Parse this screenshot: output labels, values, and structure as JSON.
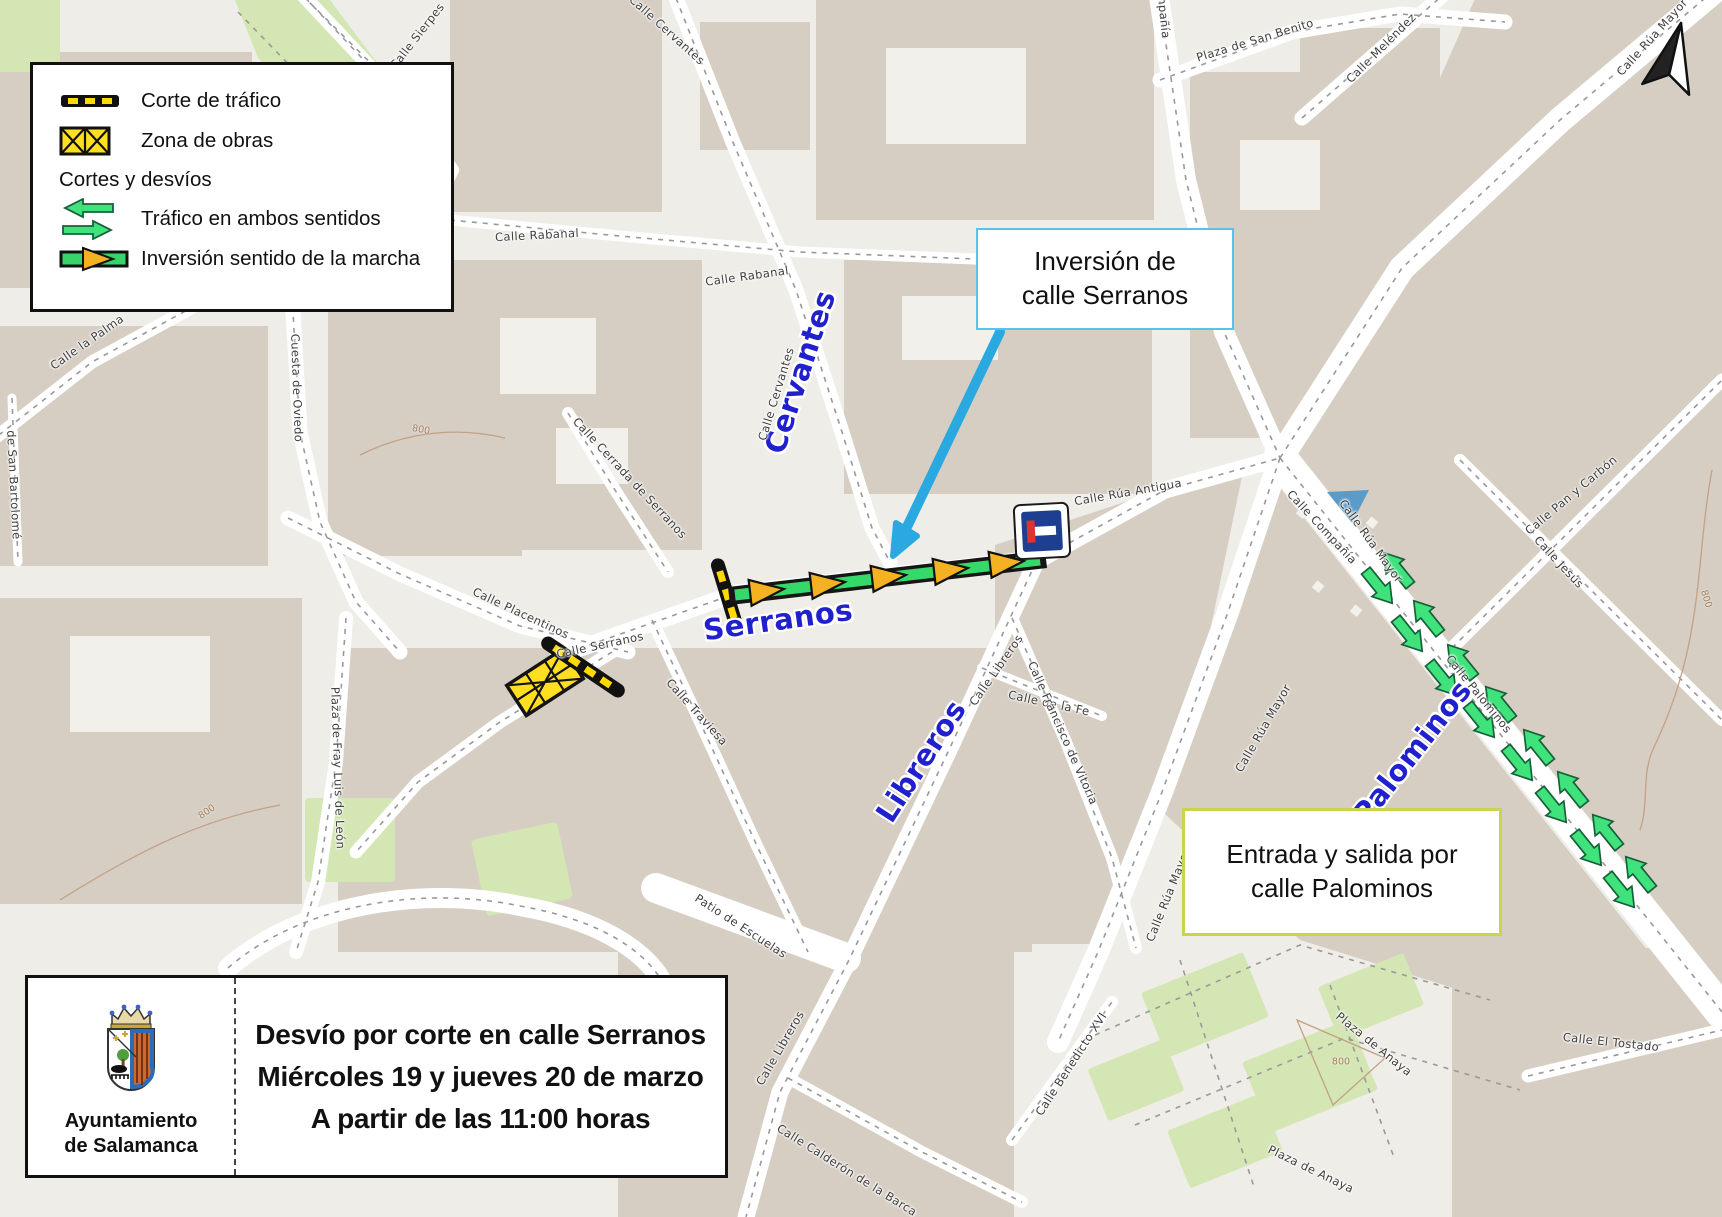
{
  "legend": {
    "items": [
      {
        "label": "Corte de tráfico",
        "icon": "traffic-cut"
      },
      {
        "label": "Zona de obras",
        "icon": "work-zone"
      },
      {
        "label": "Cortes y desvíos",
        "icon": "none"
      },
      {
        "label": "Tráfico en ambos sentidos",
        "icon": "two-way-arrows"
      },
      {
        "label": "Inversión sentido de la marcha",
        "icon": "direction-reversal"
      }
    ]
  },
  "callouts": {
    "inversion": {
      "line1": "Inversión de",
      "line2": "calle Serranos"
    },
    "entrada": {
      "line1": "Entrada y salida por",
      "line2": "calle Palominos"
    }
  },
  "info": {
    "org_line1": "Ayuntamiento",
    "org_line2": "de Salamanca",
    "title_line1": "Desvío por corte en calle Serranos",
    "title_line2": "Miércoles 19 y jueves 20 de marzo",
    "title_line3": "A partir de las 11:00 horas"
  },
  "colors": {
    "pointer_arrow_blue": "#2aa9e0",
    "inversion_border": "#56c2ef",
    "entrada_border": "#c9d64c",
    "diversion_green": "#3fe27b",
    "bar_green": "#35d96a",
    "arrow_yellow": "#f4b223",
    "cut_yellow": "#ffd900",
    "work_zone_yellow": "#ffdf1f",
    "street_label_blue": "#2020cf",
    "building_grey": "#d6cec3",
    "park_green": "#d4e6b4"
  },
  "map": {
    "labels": [
      {
        "t": "Cervantes",
        "x": 800,
        "y": 372,
        "r": -72,
        "c": "major"
      },
      {
        "t": "Serranos",
        "x": 778,
        "y": 620,
        "r": -8,
        "c": "major"
      },
      {
        "t": "Libreros",
        "x": 921,
        "y": 761,
        "r": -57,
        "c": "major"
      },
      {
        "t": "Palominos",
        "x": 1412,
        "y": 752,
        "r": -52,
        "c": "major"
      },
      {
        "t": "Calle Sierpes",
        "x": 417,
        "y": 36,
        "r": -52,
        "c": "minor"
      },
      {
        "t": "Calle Cervantes",
        "x": 667,
        "y": 30,
        "r": 42,
        "c": "minor"
      },
      {
        "t": "Calle Rabanal",
        "x": 537,
        "y": 235,
        "r": -3,
        "c": "minor"
      },
      {
        "t": "Calle Rabanal",
        "x": 747,
        "y": 276,
        "r": -8,
        "c": "minor"
      },
      {
        "t": "Calle Cervantes",
        "x": 776,
        "y": 394,
        "r": -73,
        "c": "minor"
      },
      {
        "t": "Calle Cerrada de Serranos",
        "x": 630,
        "y": 478,
        "r": 47,
        "c": "minor"
      },
      {
        "t": "Cuesta de Oviedo",
        "x": 297,
        "y": 388,
        "r": 88,
        "c": "minor"
      },
      {
        "t": "Calle la Palma",
        "x": 87,
        "y": 342,
        "r": -35,
        "c": "minor"
      },
      {
        "t": "de San Bartolomé",
        "x": 14,
        "y": 485,
        "r": 87,
        "c": "minor"
      },
      {
        "t": "Plaza de Fray Luis de León",
        "x": 338,
        "y": 768,
        "r": 88,
        "c": "minor"
      },
      {
        "t": "Calle Placentinos",
        "x": 521,
        "y": 613,
        "r": 25,
        "c": "minor"
      },
      {
        "t": "Calle Serranos",
        "x": 600,
        "y": 645,
        "r": -12,
        "c": "minor"
      },
      {
        "t": "Calle Traviesa",
        "x": 697,
        "y": 712,
        "r": 48,
        "c": "minor"
      },
      {
        "t": "Patio de Escuelas",
        "x": 741,
        "y": 926,
        "r": 33,
        "c": "minor"
      },
      {
        "t": "Calle Libreros",
        "x": 996,
        "y": 670,
        "r": -55,
        "c": "minor"
      },
      {
        "t": "Calle Libreros",
        "x": 780,
        "y": 1048,
        "r": -60,
        "c": "minor"
      },
      {
        "t": "Calle de la Fe",
        "x": 1049,
        "y": 703,
        "r": 12,
        "c": "minor"
      },
      {
        "t": "Calle Francisco de Vitoria",
        "x": 1063,
        "y": 733,
        "r": 66,
        "c": "minor"
      },
      {
        "t": "Calle Rúa Antigua",
        "x": 1128,
        "y": 492,
        "r": -10,
        "c": "minor"
      },
      {
        "t": "Compañía",
        "x": 1163,
        "y": 8,
        "r": 84,
        "c": "minor"
      },
      {
        "t": "Calle Compañía",
        "x": 1322,
        "y": 527,
        "r": 47,
        "c": "minor"
      },
      {
        "t": "Calle Rúa Mayor",
        "x": 1371,
        "y": 541,
        "r": 54,
        "c": "minor"
      },
      {
        "t": "Calle Rúa Mayor",
        "x": 1263,
        "y": 728,
        "r": -60,
        "c": "minor"
      },
      {
        "t": "Calle Rúa Mayor",
        "x": 1168,
        "y": 895,
        "r": -68,
        "c": "minor"
      },
      {
        "t": "Plaza de San Benito",
        "x": 1255,
        "y": 40,
        "r": -17,
        "c": "minor"
      },
      {
        "t": "Calle Meléndez",
        "x": 1381,
        "y": 48,
        "r": -45,
        "c": "minor"
      },
      {
        "t": "Calle Rúa Mayor",
        "x": 1652,
        "y": 37,
        "r": -48,
        "c": "minor"
      },
      {
        "t": "Calle Pan y Carbón",
        "x": 1571,
        "y": 495,
        "r": -40,
        "c": "minor"
      },
      {
        "t": "Calle Jesús",
        "x": 1559,
        "y": 562,
        "r": 47,
        "c": "minor"
      },
      {
        "t": "Calle Palominos",
        "x": 1479,
        "y": 694,
        "r": 51,
        "c": "minor"
      },
      {
        "t": "Calle Benedicto XVI",
        "x": 1071,
        "y": 1064,
        "r": -57,
        "c": "minor"
      },
      {
        "t": "Plaza de Anaya",
        "x": 1374,
        "y": 1044,
        "r": 39,
        "c": "minor"
      },
      {
        "t": "Plaza de Anaya",
        "x": 1311,
        "y": 1169,
        "r": 26,
        "c": "minor"
      },
      {
        "t": "Calle El Tostado",
        "x": 1611,
        "y": 1042,
        "r": 6,
        "c": "minor"
      },
      {
        "t": "Calle Calderón de la Barca",
        "x": 847,
        "y": 1170,
        "r": 32,
        "c": "minor"
      },
      {
        "t": "800",
        "x": 421,
        "y": 430,
        "r": 10,
        "c": "contour"
      },
      {
        "t": "800",
        "x": 207,
        "y": 812,
        "r": -35,
        "c": "contour"
      },
      {
        "t": "800",
        "x": 1341,
        "y": 1062,
        "r": 0,
        "c": "contour"
      },
      {
        "t": "800",
        "x": 1706,
        "y": 599,
        "r": 72,
        "c": "contour"
      }
    ]
  }
}
